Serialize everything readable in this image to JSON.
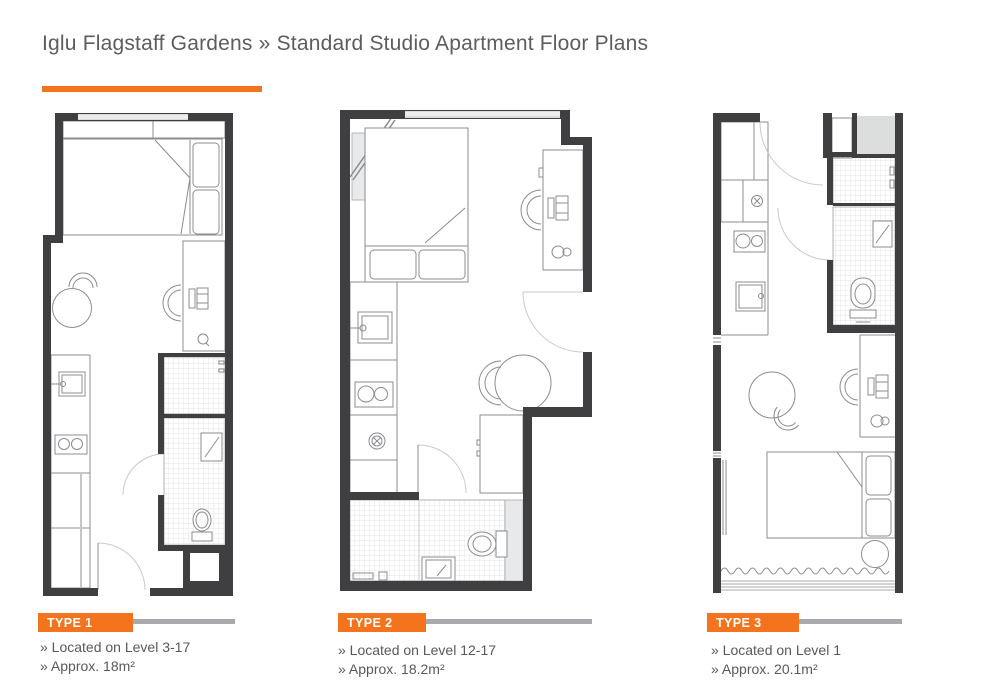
{
  "header": {
    "title": "Iglu Flagstaff Gardens » Standard Studio Apartment Floor Plans"
  },
  "plans": [
    {
      "label": "TYPE 1",
      "bullets": [
        "» Located on Level 3-17",
        "» Approx. 18m²"
      ]
    },
    {
      "label": "TYPE 2",
      "bullets": [
        "» Located on Level 12-17",
        "» Approx. 18.2m²"
      ]
    },
    {
      "label": "TYPE 3",
      "bullets": [
        "» Located on Level 1",
        "» Approx. 20.1m²"
      ]
    }
  ],
  "colors": {
    "accent_orange": "#f4731d",
    "wall_dark": "#3f3f41",
    "furniture_line_gray": "#8a8c8f",
    "caption_line_gray": "#a8aaad",
    "text_gray": "#58595b",
    "window_fill": "#d9dadb",
    "tile_line": "#dcdddd"
  }
}
